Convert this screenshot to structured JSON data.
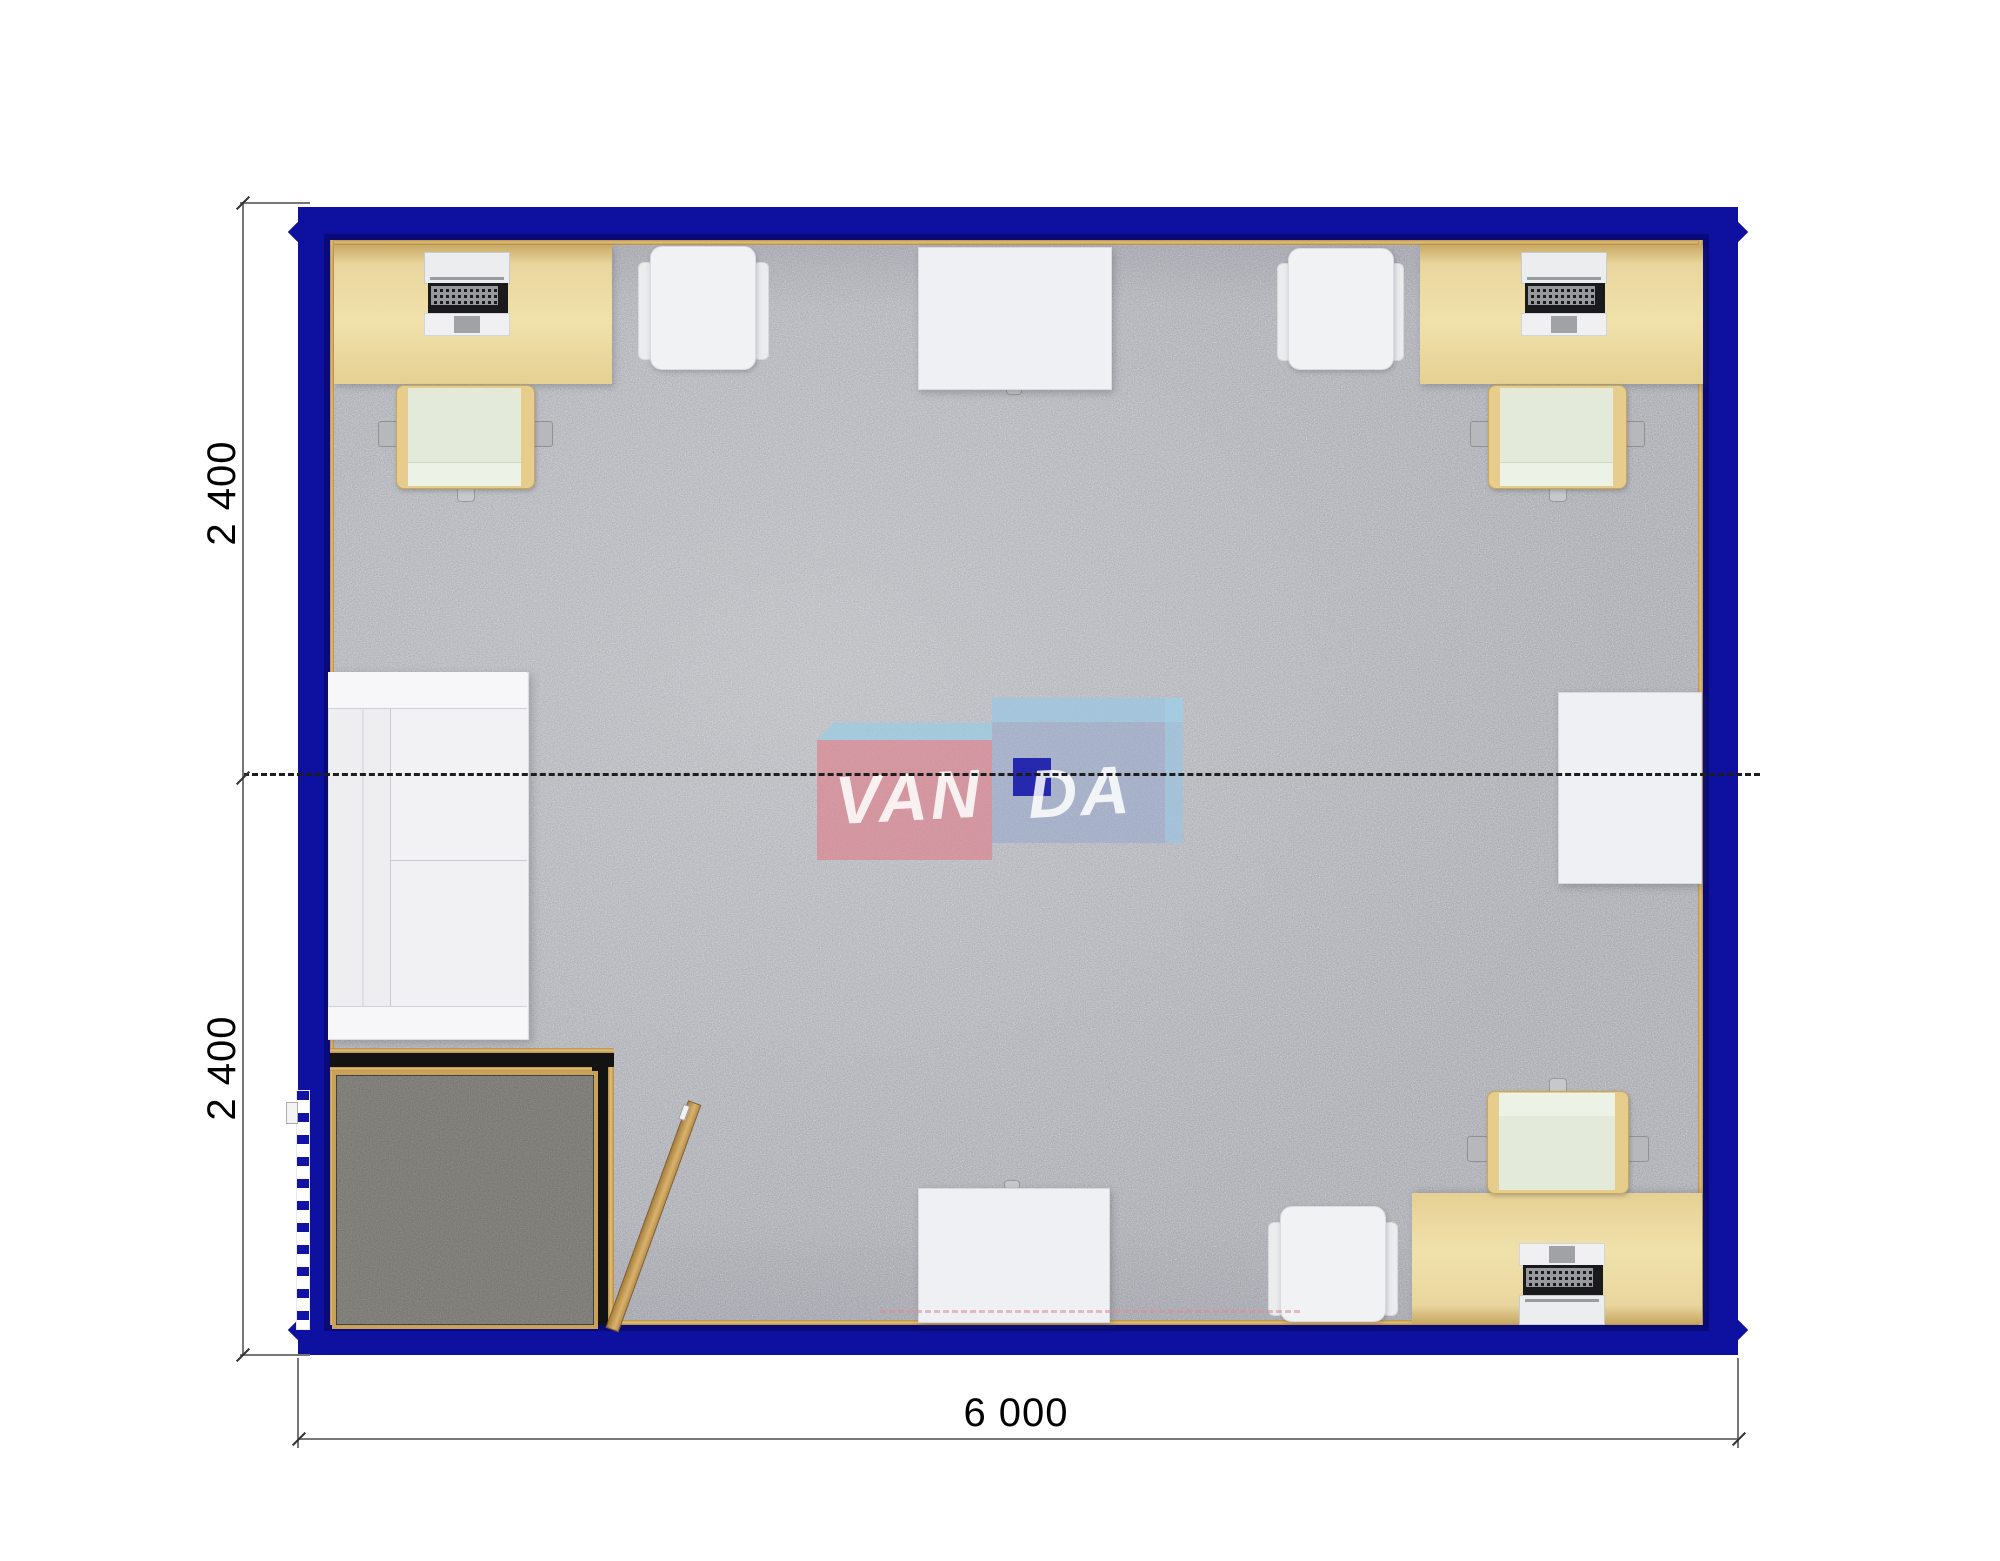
{
  "dimensions": {
    "left_top": "2 400",
    "left_bottom": "2 400",
    "bottom": "6 000"
  },
  "watermark": {
    "brand": "VANDA",
    "text_left": "VAN",
    "text_right": "DA"
  },
  "plan": {
    "type": "floor-plan-top-view",
    "building": {
      "width_mm": 6000,
      "depth_mm": 4800,
      "modules": 2,
      "module_depth_mm": 2400
    },
    "colors": {
      "wall_blue": "#0e10a0",
      "floor_carpet": "#c9cacd",
      "vestibule_carpet": "#918f89",
      "desk_wood": "#ecd9a1",
      "trim_gold": "#c49b52",
      "chair_seat_green": "#e3ead9",
      "chair_frame_gold": "#e7cd8c",
      "white_furniture": "#f1f2f4",
      "watermark_pink": "#de818d",
      "watermark_blue": "#93a6cf",
      "watermark_navy": "#1b1cab"
    },
    "furniture": [
      "desk with computer (top left)",
      "office chair (top left)",
      "visitor chair (top left)",
      "meeting table (top center)",
      "visitor chair (top right)",
      "desk with computer (top right)",
      "office chair (top right)",
      "sofa (left wall)",
      "side table (right wall)",
      "entry vestibule with inward-swinging door",
      "exterior door (left wall)",
      "desk with computer (bottom right)",
      "office chair (bottom right)",
      "table (bottom center)",
      "visitor chair (bottom center)"
    ]
  }
}
